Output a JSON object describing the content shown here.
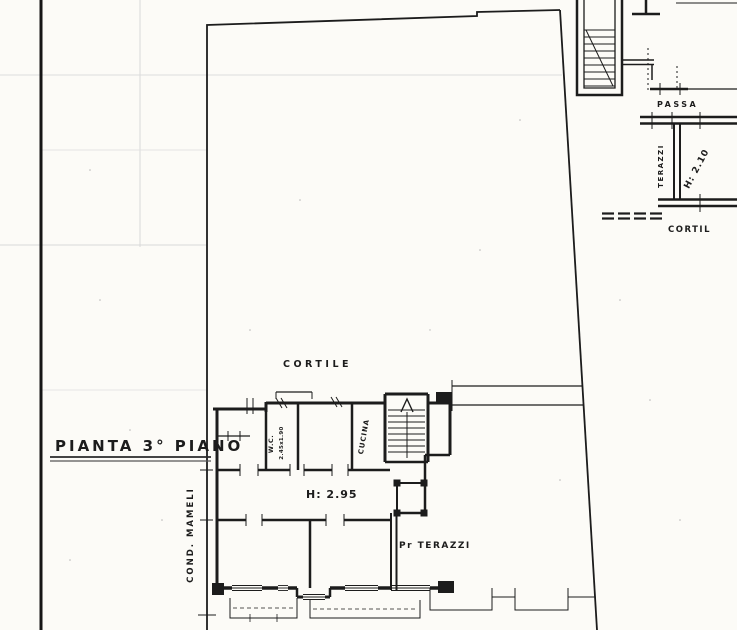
{
  "palette": {
    "paper": "#fcfbf7",
    "ink": "#1c1c1c",
    "grid": "#d8d8d8"
  },
  "plan": {
    "title": "PIANTA 3° PIANO",
    "labels": {
      "courtyard": "CORTILE",
      "street_side": "COND. MAMELI",
      "room_height": "H: 2.95",
      "terrace_access": "Pr TERAZZI",
      "wc": "W.C.",
      "wc_dimension": "2.45x1.90",
      "kitchen": "CUCINA"
    }
  },
  "adjacent_unit": {
    "labels": {
      "passage": "PASSA",
      "terrace": "TERAZZI",
      "terrace_height": "H: 2.10",
      "courtyard_partial": "CORTIL"
    }
  }
}
